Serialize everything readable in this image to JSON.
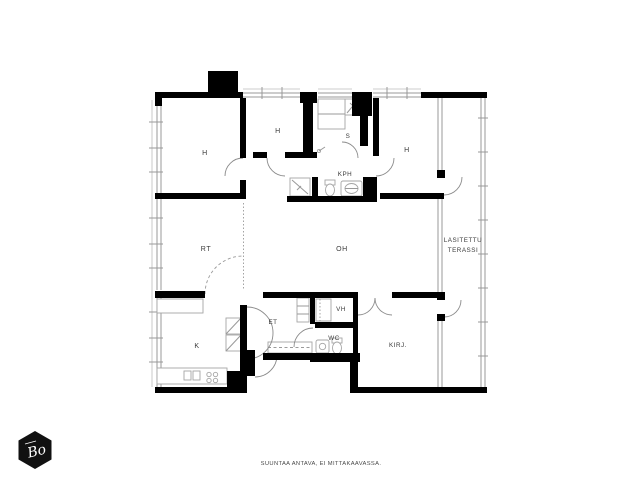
{
  "document": {
    "type_note": "apartment floor plan drawing",
    "footer_note": "SUUNTAA ANTAVA, EI MITTAKAAVASSA."
  },
  "logo": {
    "text": "Bo",
    "shape": "black-hexagon",
    "color": "#111111"
  },
  "floorplan": {
    "colors": {
      "wall": "#000000",
      "thin_line": "#999999",
      "label": "#3a3a3a"
    },
    "rooms": [
      {
        "name": "bedroom-1",
        "label": "H"
      },
      {
        "name": "bedroom-2",
        "label": "H"
      },
      {
        "name": "sauna",
        "label": "S"
      },
      {
        "name": "bathroom",
        "label": "KPH"
      },
      {
        "name": "bedroom-3",
        "label": "H"
      },
      {
        "name": "dining-workspace",
        "label": "RT"
      },
      {
        "name": "living-room",
        "label": "OH"
      },
      {
        "name": "kitchen",
        "label": "K"
      },
      {
        "name": "entry-hall",
        "label": "ET"
      },
      {
        "name": "closet",
        "label": "VH"
      },
      {
        "name": "toilet",
        "label": "WC"
      },
      {
        "name": "library",
        "label": "KIRJ."
      }
    ],
    "terrace": {
      "line1": "LASITETTU",
      "line2": "TERASSI"
    }
  }
}
